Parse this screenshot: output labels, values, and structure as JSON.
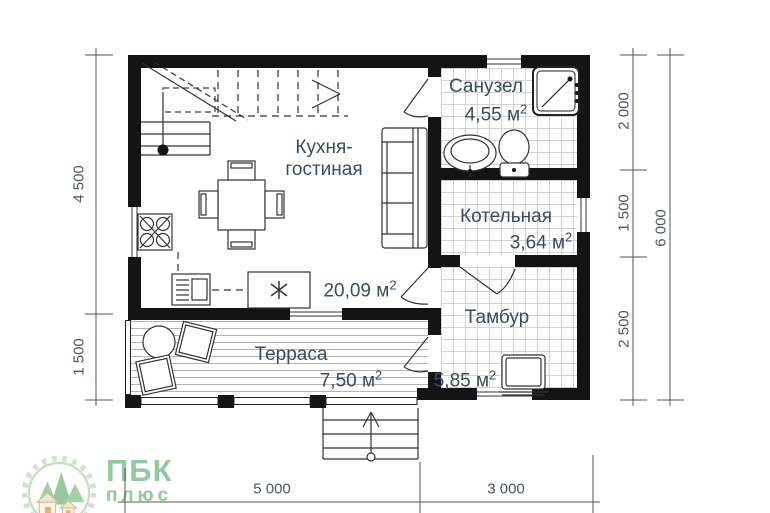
{
  "rooms": {
    "kitchen": {
      "name_line1": "Кухня-",
      "name_line2": "гостиная",
      "area_value": "20,09"
    },
    "bathroom": {
      "name": "Санузел",
      "area_value": "4,55"
    },
    "boiler": {
      "name": "Котельная",
      "area_value": "3,64"
    },
    "vestibule": {
      "name": "Тамбур",
      "area_value": "5,85"
    },
    "terrace": {
      "name": "Терраса",
      "area_value": "7,50"
    }
  },
  "units": {
    "sq_base": "м",
    "sq_sup": "2"
  },
  "dimensions": {
    "left_top": "4 500",
    "left_bottom": "1 500",
    "right_top": "2 000",
    "right_middle": "1 500",
    "right_bottom": "2 500",
    "right_total": "6 000",
    "bottom_left": "5 000",
    "bottom_right": "3 000"
  },
  "logo": {
    "line1": "ПБК",
    "line2": "плюс"
  },
  "colors": {
    "wall": "#141414",
    "label_text": "#3c4b5d",
    "dim_text": "#4c5660",
    "logo_green": "#8cc496",
    "tile_line": "#d2d2d2",
    "deck_line": "#b4b4b4"
  }
}
